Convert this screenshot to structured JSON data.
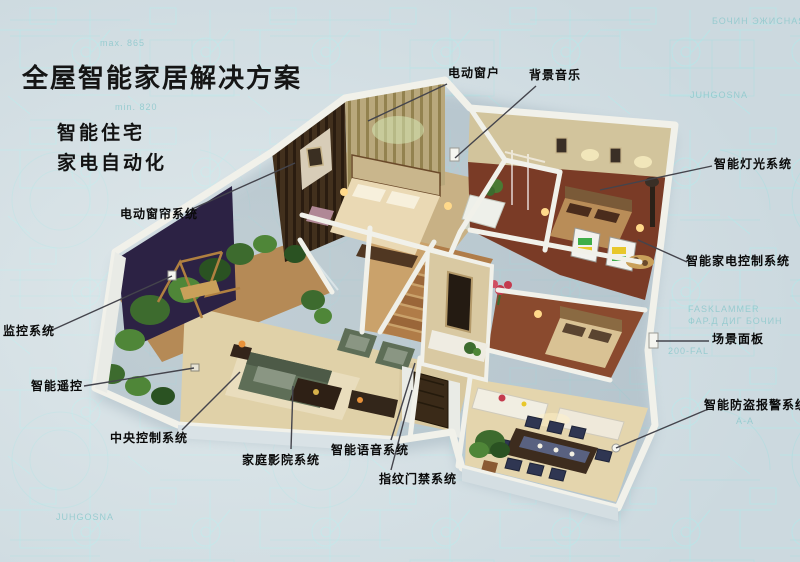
{
  "page": {
    "title": "全屋智能家居解决方案",
    "subtitle_lines": [
      "智能住宅",
      "家电自动化"
    ]
  },
  "callouts": [
    {
      "id": "electric-window",
      "text": "电动窗户",
      "x": 448,
      "y": 64,
      "line": [
        447,
        84,
        368,
        121
      ]
    },
    {
      "id": "background-music",
      "text": "背景音乐",
      "x": 529,
      "y": 66,
      "line": [
        536,
        86,
        455,
        158
      ]
    },
    {
      "id": "smart-lighting-system",
      "text": "智能灯光系统",
      "x": 714,
      "y": 155,
      "line": [
        712,
        166,
        600,
        190
      ]
    },
    {
      "id": "smart-appliance-control-system",
      "text": "智能家电控制系统",
      "x": 686,
      "y": 252,
      "line": [
        687,
        262,
        638,
        240
      ]
    },
    {
      "id": "scene-panel",
      "text": "场景面板",
      "x": 712,
      "y": 330,
      "line": [
        709,
        341,
        656,
        341
      ]
    },
    {
      "id": "smart-antitheft-alarm-system",
      "text": "智能防盗报警系统",
      "x": 704,
      "y": 396,
      "line": [
        706,
        410,
        616,
        448
      ]
    },
    {
      "id": "electric-curtain-system",
      "text": "电动窗帘系统",
      "x": 120,
      "y": 205,
      "line": [
        190,
        210,
        295,
        163
      ]
    },
    {
      "id": "monitoring-system",
      "text": "监控系统",
      "x": 3,
      "y": 322,
      "line": [
        50,
        331,
        172,
        276
      ]
    },
    {
      "id": "smart-remote-control",
      "text": "智能遥控",
      "x": 31,
      "y": 377,
      "line": [
        84,
        386,
        194,
        368
      ]
    },
    {
      "id": "central-control-system",
      "text": "中央控制系统",
      "x": 110,
      "y": 429,
      "line": [
        182,
        430,
        240,
        372
      ]
    },
    {
      "id": "home-theater-system",
      "text": "家庭影院系统",
      "x": 242,
      "y": 451,
      "line": [
        291,
        449,
        293,
        386
      ]
    },
    {
      "id": "smart-voice-system",
      "text": "智能语音系统",
      "x": 331,
      "y": 441,
      "line": [
        391,
        440,
        415,
        363
      ]
    },
    {
      "id": "fingerprint-access-system",
      "text": "指纹门禁系统",
      "x": 379,
      "y": 470,
      "line": [
        391,
        470,
        412,
        390
      ]
    }
  ],
  "background_words": [
    {
      "text": "БОЧИН ЭЖИСНАЯ",
      "x": 712,
      "y": 24
    },
    {
      "text": "JUHGOSNA",
      "x": 690,
      "y": 98
    },
    {
      "text": "max. 865",
      "x": 100,
      "y": 46
    },
    {
      "text": "min. 820",
      "x": 115,
      "y": 110
    },
    {
      "text": "FASKLAMMER",
      "x": 688,
      "y": 312
    },
    {
      "text": "ФАР.Д ДИГ БОЧИН",
      "x": 688,
      "y": 324
    },
    {
      "text": "200-FAL",
      "x": 668,
      "y": 354
    },
    {
      "text": "A-A",
      "x": 736,
      "y": 424
    },
    {
      "text": "JUHGOSNA",
      "x": 56,
      "y": 520
    }
  ],
  "palette": {
    "background": "#ccd9df",
    "blueprint_line": "#b7e6e8",
    "title_text": "#151515",
    "label_text": "#0a0a0a",
    "leader_line": "#44444c",
    "wall_white": "#f1f1ea",
    "wall_face_blue": "#d9e2e6",
    "floor_tan": "#c8b185",
    "floor_dark_wood": "#7a3b26",
    "bed_cream": "#ead9b4",
    "sofa_green": "#5e6e57",
    "plant_green": "#3d6b2e",
    "balcony_backdrop": "#2c2244",
    "appliance_green": "#3fae49",
    "appliance_yellow": "#e8c72b",
    "dining_chair_blue": "#2f3652",
    "accent_red": "#c43b4e"
  }
}
